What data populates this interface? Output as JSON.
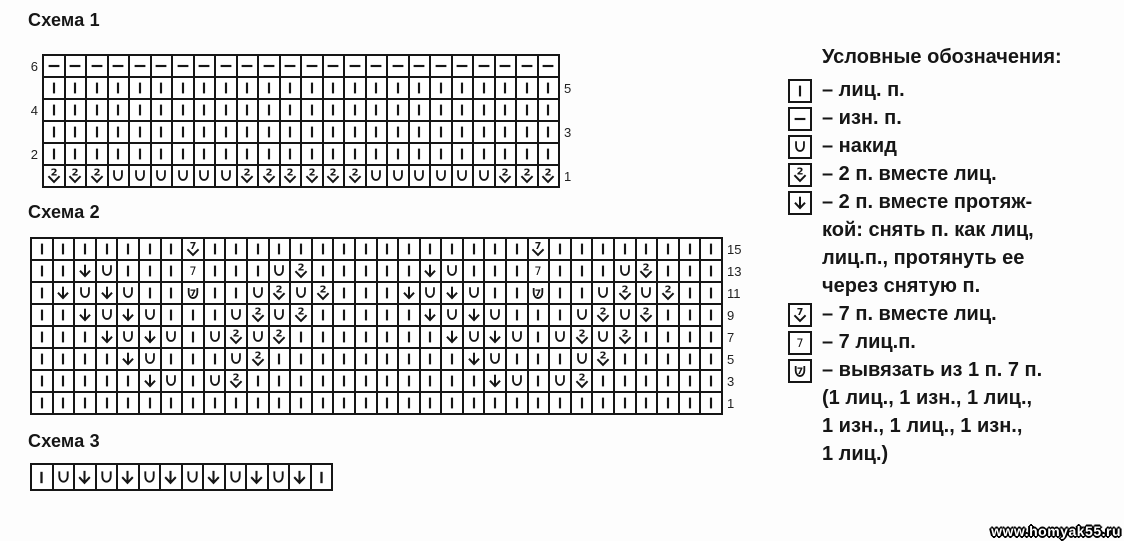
{
  "page": {
    "background": "#fdfdfd",
    "ink": "#161616",
    "watermark": "www.homyak55.ru"
  },
  "symbol_key": {
    "k": {
      "icon": "knit",
      "glyph": "vertical-bar",
      "meaning": "лиц. п."
    },
    "p": {
      "icon": "purl",
      "glyph": "horizontal-dash",
      "meaning": "изн. п."
    },
    "o": {
      "icon": "yarnover",
      "glyph": "U",
      "meaning": "накид"
    },
    "2": {
      "icon": "k2tog",
      "glyph": "2-over-chevron",
      "meaning": "2 п. вместе лиц."
    },
    "s": {
      "icon": "ssk",
      "glyph": "down-arrow",
      "meaning": "2 п. вместе протяжкой"
    },
    "7": {
      "icon": "k7tog",
      "glyph": "7-over-chevron",
      "meaning": "7 п. вместе лиц."
    },
    "K": {
      "icon": "knit7",
      "glyph": "7",
      "meaning": "7 лиц.п."
    },
    "M": {
      "icon": "make7",
      "glyph": "7-in-cup",
      "meaning": "вывязать из 1 п. 7 п."
    }
  },
  "chart_data": [
    {
      "id": "schema1",
      "type": "table",
      "title": "Схема 1",
      "columns": 24,
      "rows": [
        {
          "left": "6",
          "right": "",
          "cells": "pppppppppppppppppppppppp"
        },
        {
          "left": "",
          "right": "5",
          "cells": "kkkkkkkkkkkkkkkkkkkkkkkk"
        },
        {
          "left": "4",
          "right": "",
          "cells": "kkkkkkkkkkkkkkkkkkkkkkkk"
        },
        {
          "left": "",
          "right": "3",
          "cells": "kkkkkkkkkkkkkkkkkkkkkkkk"
        },
        {
          "left": "2",
          "right": "",
          "cells": "kkkkkkkkkkkkkkkkkkkkkkkk"
        },
        {
          "left": "",
          "right": "1",
          "cells": "222oooooo222222oooooo222"
        }
      ]
    },
    {
      "id": "schema2",
      "type": "table",
      "title": "Схема 2",
      "columns": 32,
      "rows": [
        {
          "left": "",
          "right": "15",
          "cells": "kkkkkkk7kkkkkkkkkkkkkkk7kkkkkkkk"
        },
        {
          "left": "",
          "right": "13",
          "cells": "kksokkkKkkko2kkkkksokkkKkkko2kkk"
        },
        {
          "left": "",
          "right": "11",
          "cells": "ksosokkMkko2o2kkksosokkMkko2o2kk"
        },
        {
          "left": "",
          "right": "9",
          "cells": "kksosokkko2o2kkkkksosokkko2o2kkk"
        },
        {
          "left": "",
          "right": "7",
          "cells": "kkksosoko2o2kkkkkkksosoko2o2kkkk"
        },
        {
          "left": "",
          "right": "5",
          "cells": "kkkksokkko2kkkkkkkkksokkko2kkkkk"
        },
        {
          "left": "",
          "right": "3",
          "cells": "kkkkksoko2kkkkkkkkkkksoko2kkkkkk"
        },
        {
          "left": "",
          "right": "1",
          "cells": "kkkkkkkkkkkkkkkkkkkkkkkkkkkkkkkk"
        }
      ]
    },
    {
      "id": "schema3",
      "type": "table",
      "title": "Схема 3",
      "columns": 14,
      "rows": [
        {
          "left": "",
          "right": "",
          "cells": "kososososososk"
        }
      ]
    }
  ],
  "legend": {
    "title": "Условные обозначения:",
    "items": [
      {
        "symbol": "k",
        "lines": [
          "– лиц. п."
        ]
      },
      {
        "symbol": "p",
        "lines": [
          "– изн. п."
        ]
      },
      {
        "symbol": "o",
        "lines": [
          "– накид"
        ]
      },
      {
        "symbol": "2",
        "lines": [
          "– 2 п. вместе лиц."
        ]
      },
      {
        "symbol": "s",
        "lines": [
          "– 2 п. вместе протяж-",
          "кой: снять п. как лиц,",
          "лиц.п., протянуть ее",
          "через снятую п."
        ]
      },
      {
        "symbol": "7",
        "lines": [
          "– 7 п. вместе лиц."
        ]
      },
      {
        "symbol": "K",
        "lines": [
          "– 7 лиц.п."
        ]
      },
      {
        "symbol": "M",
        "lines": [
          "– вывязать из 1 п. 7 п.",
          "(1 лиц., 1 изн., 1 лиц.,",
          "1 изн., 1 лиц., 1 изн.,",
          "1 лиц.)"
        ]
      }
    ]
  }
}
